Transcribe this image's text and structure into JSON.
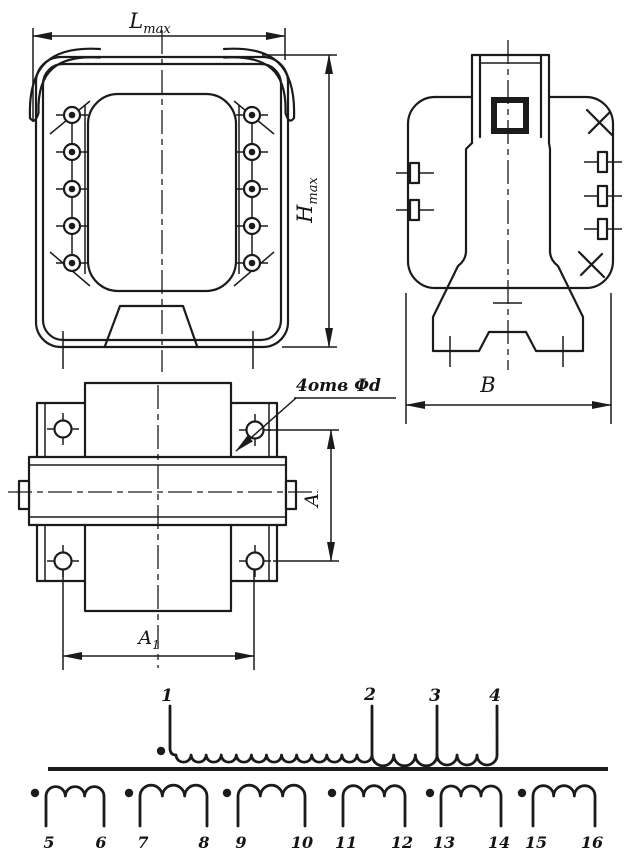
{
  "colors": {
    "ink": "#1b1b1b",
    "paper": "#ffffff"
  },
  "dimensions": {
    "length": {
      "base": "L",
      "sub": "max"
    },
    "height": {
      "base": "H",
      "sub": "max"
    },
    "width_label": "В",
    "a_label": "A",
    "a1": {
      "base": "A",
      "sub": "1"
    },
    "holes_note": "4отв Φd"
  },
  "schematic": {
    "primary": {
      "terminals": [
        "1",
        "2",
        "3",
        "4"
      ],
      "section_loops": [
        13,
        3,
        3
      ]
    },
    "secondaries": [
      {
        "start": "5",
        "end": "6",
        "loops": 3
      },
      {
        "start": "7",
        "end": "8",
        "loops": 3
      },
      {
        "start": "9",
        "end": "10",
        "loops": 3
      },
      {
        "start": "11",
        "end": "12",
        "loops": 3
      },
      {
        "start": "13",
        "end": "14",
        "loops": 3
      },
      {
        "start": "15",
        "end": "16",
        "loops": 3
      }
    ]
  }
}
